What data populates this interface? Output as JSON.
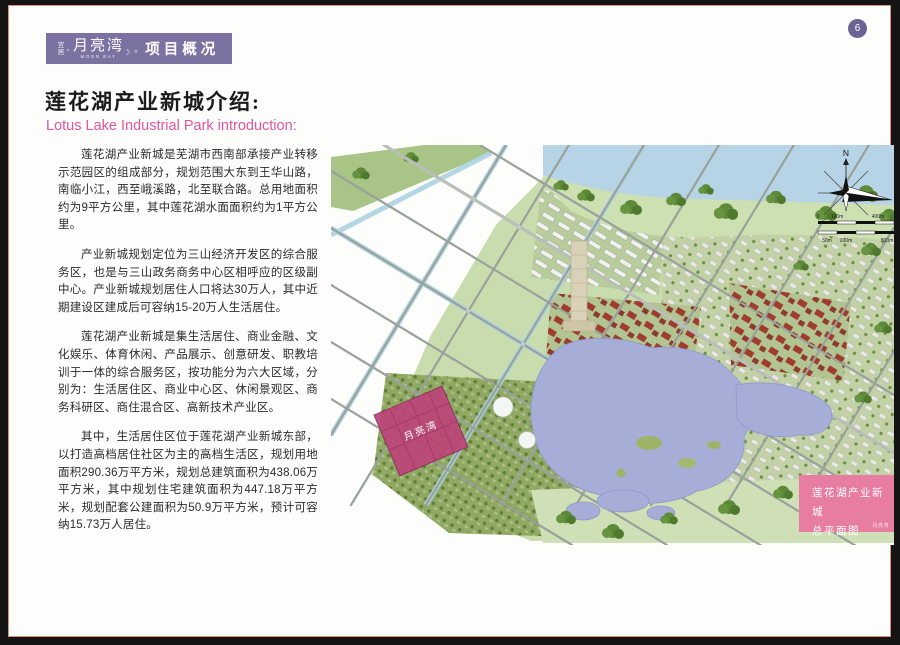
{
  "page": {
    "number": "6"
  },
  "banner": {
    "residence": "宜居",
    "dot": "·",
    "brand": "月亮湾",
    "brand_en": "MOON BAY",
    "sep": "。",
    "section": "项目概况"
  },
  "icons": {
    "crescent_moon": "☽"
  },
  "intro": {
    "title_cn": "莲花湖产业新城介绍:",
    "title_en": "Lotus Lake Industrial Park introduction:"
  },
  "body": {
    "paragraphs": [
      "莲花湖产业新城是芜湖市西南部承接产业转移示范园区的组成部分，规划范围大东到王华山路，南临小江，西至峨溪路，北至联合路。总用地面积约为9平方公里，其中莲花湖水面面积约为1平方公里。",
      "产业新城规划定位为三山经济开发区的综合服务区，也是与三山政务商务中心区相呼应的区级副中心。产业新城规划居住人口将达30万人，其中近期建设区建成后可容纳15-20万人生活居住。",
      "莲花湖产业新城是集生活居住、商业金融、文化娱乐、体育休闲、产品展示、创意研发、职教培训于一体的综合服务区，按功能分为六大区域，分别为：生活居住区、商业中心区、休闲景观区、商务科研区、商住混合区、高新技术产业区。",
      "其中，生活居住区位于莲花湖产业新城东部，以打造高档居住社区为主的高档生活区，规划用地面积290.36万平方米，规划总建筑面积为438.06万平方米，其中规划住宅建筑面积为447.18万平方米，规划配套公建面积为50.9万平方米，预计可容纳15.73万人居住。"
    ]
  },
  "map": {
    "parcel_label": "月亮湾",
    "compass_n": "N",
    "scale_top": [
      "0",
      "100m",
      "400m"
    ],
    "scale_bottom": [
      "50m",
      "200m",
      "800m"
    ],
    "legend": {
      "line1": "莲花湖产业新城",
      "line2": "总平面图",
      "small": "月亮湾"
    }
  },
  "colors": {
    "banner_purple": "#7b72a1",
    "accent_pink": "#e1559f",
    "legend_pink": "#e87da2",
    "parcel_magenta": "#bd4579",
    "lake_blue": "#a6aed8",
    "river_blue": "#b7d4e6",
    "page_border": "#d8917a"
  }
}
